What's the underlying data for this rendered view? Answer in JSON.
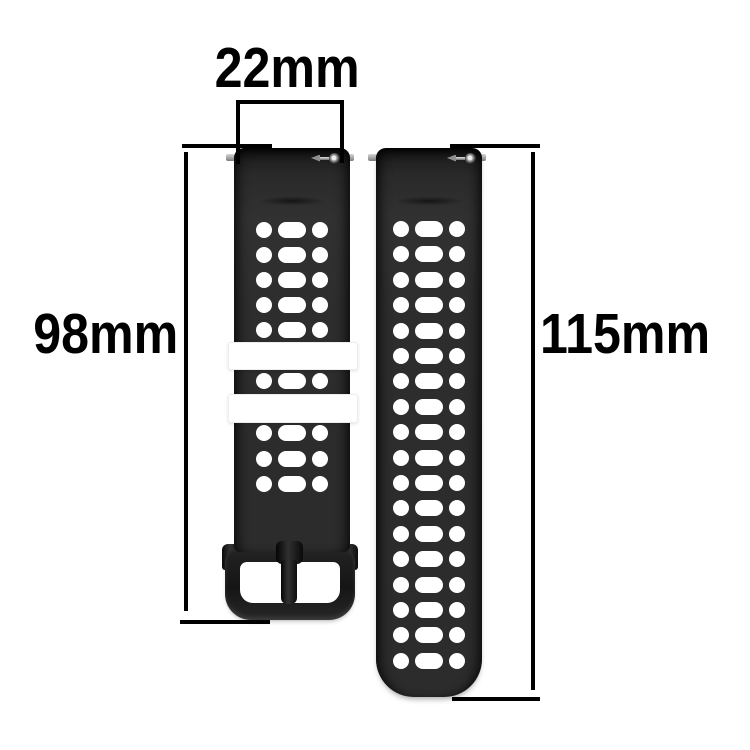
{
  "diagram": {
    "alt": "Black perforated silicone watch strap, two pieces, with dimension measurements"
  },
  "dimensions": {
    "width_label": "22mm",
    "left_strap_length_label": "98mm",
    "right_strap_length_label": "115mm"
  },
  "straps": {
    "left": {
      "hole_rows_above_keepers": 5,
      "hole_rows_between_keepers": 1,
      "hole_rows_below_keepers": 3,
      "keeper_count": 2,
      "has_buckle": true,
      "color": "#2d2d2d",
      "keeper_color": "#ffffff"
    },
    "right": {
      "hole_rows": 18,
      "has_buckle": false,
      "color": "#2d2d2d"
    }
  },
  "colors": {
    "background": "#ffffff",
    "dimension_lines": "#000000",
    "label_text": "#000000",
    "buckle": "#1e1e1e",
    "hole": "#ffffff",
    "spring_bar_pins": "#b5b5b5"
  }
}
